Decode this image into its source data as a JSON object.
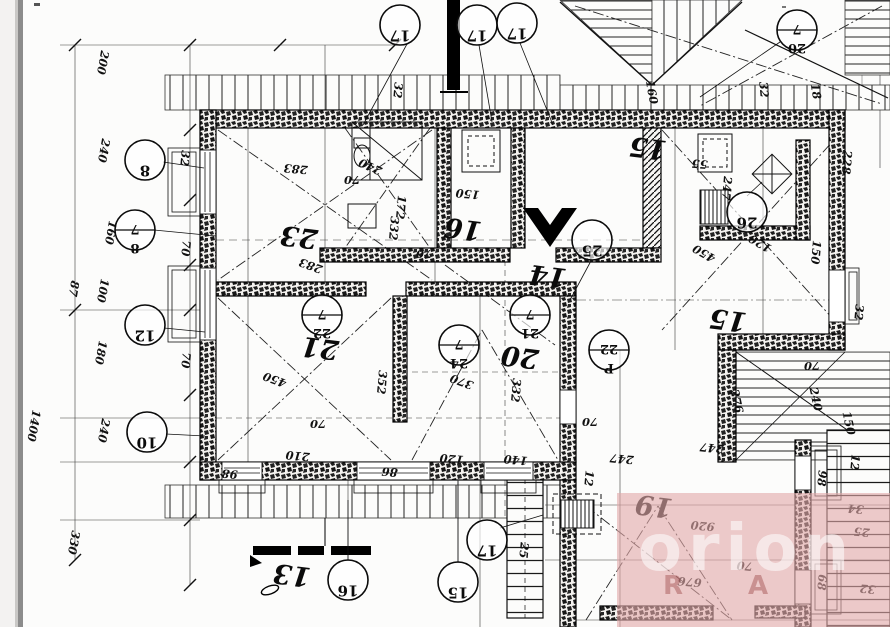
{
  "document": {
    "kind": "scanned architectural floor plan (attic storey), drawing rotated 180°",
    "paper_color": "#fcfcfb",
    "ink_color": "#111111",
    "scan_edge_color": "#8c8c8c"
  },
  "watermark": {
    "text": "orion",
    "sub_letters": [
      {
        "t": "R",
        "x": 663,
        "y": 594
      },
      {
        "t": "A",
        "x": 748,
        "y": 594
      }
    ],
    "box_color": "#e2aaaa",
    "letter_color": "rgba(255,255,255,0.55)",
    "sub_color": "rgba(150,60,60,0.40)"
  },
  "rooms": [
    {
      "t": "23",
      "x": 300,
      "y": 228
    },
    {
      "t": "16",
      "x": 464,
      "y": 220
    },
    {
      "t": "15",
      "x": 649,
      "y": 139
    },
    {
      "t": "14",
      "x": 549,
      "y": 267
    },
    {
      "t": "21",
      "x": 321,
      "y": 339
    },
    {
      "t": "20",
      "x": 521,
      "y": 348
    },
    {
      "t": "15",
      "x": 729,
      "y": 311
    },
    {
      "t": "19",
      "x": 655,
      "y": 497
    },
    {
      "t": "13",
      "x": 293,
      "y": 566
    }
  ],
  "circles": [
    {
      "x": 400,
      "y": 25,
      "top": "17"
    },
    {
      "x": 477,
      "y": 25,
      "top": "17"
    },
    {
      "x": 517,
      "y": 23,
      "top": "17"
    },
    {
      "x": 797,
      "y": 30,
      "top": "7",
      "bot": "20"
    },
    {
      "x": 145,
      "y": 160,
      "top": "8"
    },
    {
      "x": 135,
      "y": 230,
      "top": "7",
      "bot": "8"
    },
    {
      "x": 145,
      "y": 325,
      "top": "12"
    },
    {
      "x": 147,
      "y": 432,
      "top": "10"
    },
    {
      "x": 322,
      "y": 315,
      "top": "7",
      "bot": "22"
    },
    {
      "x": 530,
      "y": 315,
      "top": "7",
      "bot": "21"
    },
    {
      "x": 459,
      "y": 345,
      "top": "7",
      "bot": "24"
    },
    {
      "x": 609,
      "y": 350,
      "top": "22",
      "bot": "P"
    },
    {
      "x": 747,
      "y": 212,
      "top": "26"
    },
    {
      "x": 592,
      "y": 240,
      "top": "25"
    },
    {
      "x": 348,
      "y": 580,
      "top": "16"
    },
    {
      "x": 458,
      "y": 582,
      "top": "15"
    },
    {
      "x": 487,
      "y": 540,
      "top": "17"
    }
  ],
  "dims": [
    {
      "t": "200",
      "x": 99,
      "y": 62,
      "a": 100
    },
    {
      "t": "240",
      "x": 100,
      "y": 150,
      "a": 100
    },
    {
      "t": "160",
      "x": 107,
      "y": 232,
      "a": 100
    },
    {
      "t": "100",
      "x": 99,
      "y": 290,
      "a": 100
    },
    {
      "t": "87",
      "x": 70,
      "y": 288,
      "a": 100
    },
    {
      "t": "180",
      "x": 97,
      "y": 352,
      "a": 100
    },
    {
      "t": "240",
      "x": 100,
      "y": 430,
      "a": 100
    },
    {
      "t": "1400",
      "x": 30,
      "y": 425,
      "a": 100
    },
    {
      "t": "330",
      "x": 70,
      "y": 542,
      "a": 100
    },
    {
      "t": "32",
      "x": 394,
      "y": 90,
      "a": 95
    },
    {
      "t": "160",
      "x": 648,
      "y": 93,
      "a": 80
    },
    {
      "t": "18",
      "x": 812,
      "y": 92,
      "a": 80
    },
    {
      "t": "32",
      "x": 181,
      "y": 158,
      "a": 95
    },
    {
      "t": "32",
      "x": 760,
      "y": 90,
      "a": 85
    },
    {
      "t": "283",
      "x": 296,
      "y": 165,
      "a": 185
    },
    {
      "t": "332",
      "x": 390,
      "y": 228,
      "a": 95
    },
    {
      "t": "283",
      "x": 312,
      "y": 262,
      "a": 200
    },
    {
      "t": "240",
      "x": 372,
      "y": 163,
      "a": 205
    },
    {
      "t": "172",
      "x": 397,
      "y": 207,
      "a": 95
    },
    {
      "t": "150",
      "x": 468,
      "y": 190,
      "a": 185
    },
    {
      "t": "70",
      "x": 424,
      "y": 250,
      "a": 180
    },
    {
      "t": "70",
      "x": 352,
      "y": 176,
      "a": 180
    },
    {
      "t": "247",
      "x": 723,
      "y": 188,
      "a": 95
    },
    {
      "t": "228",
      "x": 843,
      "y": 162,
      "a": 95
    },
    {
      "t": "150",
      "x": 812,
      "y": 252,
      "a": 95
    },
    {
      "t": "120",
      "x": 762,
      "y": 240,
      "a": 210
    },
    {
      "t": "450",
      "x": 706,
      "y": 250,
      "a": 210
    },
    {
      "t": "55",
      "x": 700,
      "y": 160,
      "a": 185
    },
    {
      "t": "32",
      "x": 855,
      "y": 312,
      "a": 95
    },
    {
      "t": "70",
      "x": 812,
      "y": 362,
      "a": 180
    },
    {
      "t": "276",
      "x": 733,
      "y": 402,
      "a": 78
    },
    {
      "t": "240",
      "x": 812,
      "y": 400,
      "a": 78
    },
    {
      "t": "150",
      "x": 845,
      "y": 424,
      "a": 78
    },
    {
      "t": "450",
      "x": 276,
      "y": 376,
      "a": 200
    },
    {
      "t": "352",
      "x": 378,
      "y": 382,
      "a": 95
    },
    {
      "t": "370",
      "x": 463,
      "y": 378,
      "a": 200
    },
    {
      "t": "332",
      "x": 512,
      "y": 390,
      "a": 95
    },
    {
      "t": "210",
      "x": 298,
      "y": 452,
      "a": 185
    },
    {
      "t": "70",
      "x": 318,
      "y": 420,
      "a": 180
    },
    {
      "t": "70",
      "x": 590,
      "y": 418,
      "a": 180
    },
    {
      "t": "98",
      "x": 230,
      "y": 470,
      "a": 185
    },
    {
      "t": "86",
      "x": 390,
      "y": 468,
      "a": 185
    },
    {
      "t": "120",
      "x": 452,
      "y": 455,
      "a": 185
    },
    {
      "t": "140",
      "x": 516,
      "y": 456,
      "a": 185
    },
    {
      "t": "247",
      "x": 622,
      "y": 455,
      "a": 185
    },
    {
      "t": "247",
      "x": 712,
      "y": 444,
      "a": 185
    },
    {
      "t": "12",
      "x": 585,
      "y": 478,
      "a": 95
    },
    {
      "t": "920",
      "x": 703,
      "y": 522,
      "a": 185
    },
    {
      "t": "676",
      "x": 690,
      "y": 578,
      "a": 185
    },
    {
      "t": "70",
      "x": 745,
      "y": 562,
      "a": 185
    },
    {
      "t": "98",
      "x": 818,
      "y": 478,
      "a": 95
    },
    {
      "t": "68",
      "x": 818,
      "y": 582,
      "a": 95
    },
    {
      "t": "25",
      "x": 520,
      "y": 550,
      "a": 95
    },
    {
      "t": "25",
      "x": 862,
      "y": 528,
      "a": 185
    },
    {
      "t": "32",
      "x": 868,
      "y": 585,
      "a": 185
    },
    {
      "t": "34",
      "x": 856,
      "y": 505,
      "a": 185
    },
    {
      "t": "12",
      "x": 851,
      "y": 462,
      "a": 95
    },
    {
      "t": "70",
      "x": 182,
      "y": 248,
      "a": 95
    },
    {
      "t": "70",
      "x": 182,
      "y": 360,
      "a": 95
    }
  ],
  "leaders": [
    [
      407,
      44,
      363,
      125
    ],
    [
      479,
      45,
      492,
      122
    ],
    [
      520,
      43,
      553,
      125
    ],
    [
      780,
      42,
      700,
      97
    ],
    [
      163,
      162,
      204,
      168
    ],
    [
      154,
      230,
      216,
      236
    ],
    [
      164,
      328,
      205,
      332
    ],
    [
      166,
      434,
      205,
      436
    ],
    [
      592,
      259,
      570,
      300
    ],
    [
      747,
      196,
      762,
      182
    ],
    [
      348,
      561,
      348,
      500
    ],
    [
      458,
      563,
      458,
      481
    ],
    [
      500,
      528,
      543,
      515
    ]
  ]
}
